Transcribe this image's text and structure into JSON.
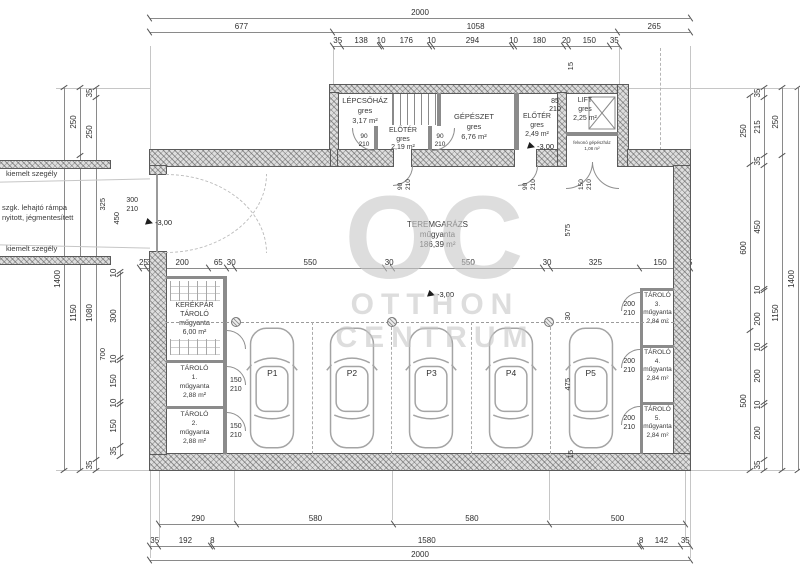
{
  "watermark": {
    "monogram": "OC",
    "line1": "OTTHON",
    "line2": "CENTRUM"
  },
  "colors": {
    "wall_fill": "#dedede",
    "line": "#5a5a5a",
    "dim_text": "#2e2e2e",
    "watermark": "#c8c8c8",
    "car_outline": "#a4a4a4"
  },
  "rooms": {
    "lepcsohaz": {
      "name": "LÉPCSŐHÁZ",
      "finish": "gres",
      "area": "3,17 m²"
    },
    "eloter1": {
      "name": "ELŐTÉR",
      "finish": "gres",
      "area": "2,19 m²"
    },
    "gepeszet": {
      "name": "GÉPÉSZET",
      "finish": "gres",
      "area": "6,76 m²"
    },
    "eloter2": {
      "name": "ELŐTÉR",
      "finish": "gres",
      "area": "2,49 m²"
    },
    "lift": {
      "name": "LIFT",
      "finish": "gres",
      "area": "2,25 m²"
    },
    "machine": {
      "line1": "felvonó gépészház",
      "area": "1,08 m²"
    },
    "teremgarazs": {
      "name": "TEREMGARÁZS",
      "finish": "műgyanta",
      "area": "186,39 m²"
    },
    "kerekpar": {
      "name1": "KERÉKPÁR",
      "name2": "TÁROLÓ",
      "finish": "műgyanta",
      "area": "6,00 m²"
    },
    "tarolo1": {
      "name": "TÁROLÓ",
      "num": "1.",
      "finish": "műgyanta",
      "area": "2,88 m²"
    },
    "tarolo2": {
      "name": "TÁROLÓ",
      "num": "2.",
      "finish": "műgyanta",
      "area": "2,88 m²"
    },
    "tarolo3": {
      "name": "TÁROLÓ",
      "num": "3.",
      "finish": "műgyanta",
      "area": "2,84 m²"
    },
    "tarolo4": {
      "name": "TÁROLÓ",
      "num": "4.",
      "finish": "műgyanta",
      "area": "2,84 m²"
    },
    "tarolo5": {
      "name": "TÁROLÓ",
      "num": "5.",
      "finish": "műgyanta",
      "area": "2,84 m²"
    }
  },
  "ramp": {
    "curb_top": "kiemelt szegély",
    "curb_bottom": "kiemelt szegély",
    "label_line1": "szgk. lehajtó rámpa",
    "label_line2": "nyitott, jégmentesített"
  },
  "levels": {
    "ramp": "-3,00",
    "eloter": "-3,00",
    "garage": "-3,00"
  },
  "doors": {
    "eloter1_left": [
      "90",
      "210"
    ],
    "eloter1_right": [
      "90",
      "210"
    ],
    "garage_door_left": [
      "90",
      "210"
    ],
    "garage_door_right": [
      "90",
      "210"
    ],
    "lift_door": [
      "85",
      "210"
    ],
    "lobby_door": [
      "150",
      "210"
    ],
    "ramp_gate": [
      "300",
      "210"
    ],
    "tarolo1_door": [
      "150",
      "210"
    ],
    "tarolo2_door": [
      "150",
      "210"
    ],
    "tarolo3_door": [
      "200",
      "210"
    ],
    "tarolo4_door": [
      "200",
      "210"
    ],
    "tarolo5_door": [
      "200",
      "210"
    ]
  },
  "parking": [
    {
      "label": "P1"
    },
    {
      "label": "P2"
    },
    {
      "label": "P3"
    },
    {
      "label": "P4"
    },
    {
      "label": "P5"
    }
  ],
  "dims": {
    "top_total": [
      2000
    ],
    "top_spans": [
      677,
      1058,
      265
    ],
    "top_detail": [
      35,
      138,
      10,
      176,
      10,
      294,
      10,
      180,
      20,
      150,
      35
    ],
    "mid": [
      25,
      30,
      200,
      65,
      30,
      550,
      30,
      550,
      30,
      325,
      150,
      20,
      15
    ],
    "bottom_spans": [
      290,
      580,
      580,
      500
    ],
    "bottom_detail": [
      35,
      192,
      8,
      1580,
      8,
      142,
      35
    ],
    "bottom_total": [
      2000
    ],
    "left_outer": [
      1400
    ],
    "left_mid": [
      250,
      1150
    ],
    "left_inner": [
      35,
      250,
      1080,
      35
    ],
    "left_storage": [
      10,
      300,
      10,
      150,
      10,
      150,
      35
    ],
    "right_room": [
      250,
      600,
      500
    ],
    "right_detail": [
      35,
      215,
      35,
      450,
      10,
      200,
      10,
      200,
      10,
      200,
      35
    ],
    "right_mid": [
      250,
      1150
    ],
    "right_outer": [
      1400
    ],
    "interior": {
      "lift_top": "15",
      "garage_upper": "575",
      "stall_top": "30",
      "stall_len": "475",
      "bottom_edge": "15",
      "ramp_width": "325",
      "ramp_opening": "450",
      "left_bay": "700"
    }
  }
}
